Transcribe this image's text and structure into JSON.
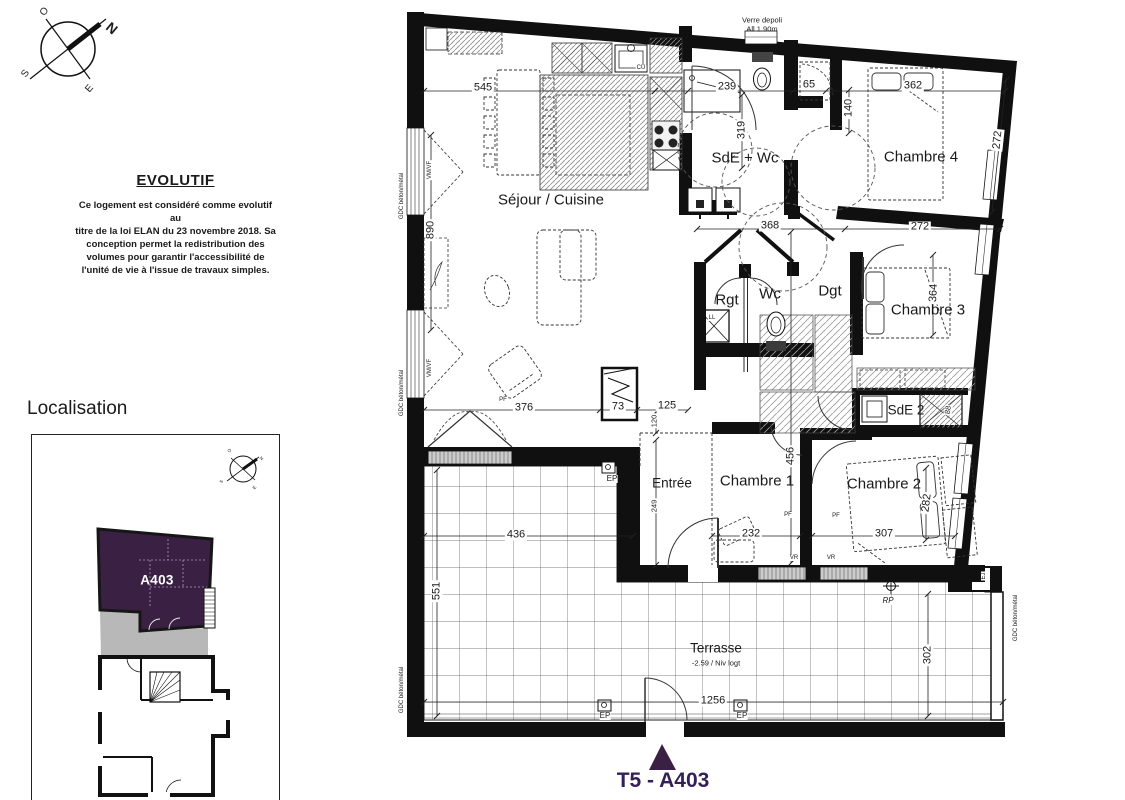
{
  "colors": {
    "plum": "#3a2144",
    "footer_text": "#342058",
    "wall": "#101010",
    "terrace_gray": "#b8b8b8"
  },
  "compass": {
    "labels": [
      {
        "t": "N",
        "x": 112,
        "y": 28,
        "rot": 40,
        "cls": "cN"
      },
      {
        "t": "O",
        "x": 45,
        "y": 12,
        "rot": -55,
        "cls": "cO"
      },
      {
        "t": "S",
        "x": 26,
        "y": 74,
        "rot": -55,
        "cls": "cO"
      },
      {
        "t": "E",
        "x": 90,
        "y": 89,
        "rot": -50,
        "cls": "cO"
      },
      {
        "t": "N",
        "x": 261,
        "y": 459,
        "rot": 40,
        "cls": "cMini"
      },
      {
        "t": "O",
        "x": 230,
        "y": 451,
        "rot": -55,
        "cls": "cMini"
      },
      {
        "t": "S",
        "x": 222,
        "y": 482,
        "rot": -55,
        "cls": "cMini"
      },
      {
        "t": "E",
        "x": 255,
        "y": 488,
        "rot": -50,
        "cls": "cMini"
      }
    ]
  },
  "evolutif": {
    "title": "EVOLUTIF",
    "body_lines": [
      "Ce logement est considéré comme evolutif au",
      "titre de la loi ELAN du 23 novembre 2018. Sa",
      "conception permet la redistribution des",
      "volumes pour garantir l'accessibilité de",
      "l'unité de vie à l'issue de travaux simples."
    ]
  },
  "localisation": {
    "title": "Localisation",
    "unit": "A403"
  },
  "footer": {
    "label": "T5 - A403"
  },
  "plan": {
    "rooms": [
      {
        "t": "Séjour / Cuisine",
        "x": 551,
        "y": 200
      },
      {
        "t": "SdE + Wc",
        "x": 745,
        "y": 158
      },
      {
        "t": "Chambre 4",
        "x": 921,
        "y": 157
      },
      {
        "t": "Rgt",
        "x": 727,
        "y": 300
      },
      {
        "t": "Wc",
        "x": 770,
        "y": 294
      },
      {
        "t": "Dgt",
        "x": 830,
        "y": 291
      },
      {
        "t": "Chambre 3",
        "x": 928,
        "y": 310
      },
      {
        "t": "SdE 2",
        "x": 906,
        "y": 410,
        "cls": "room-sm"
      },
      {
        "t": "Entrée",
        "x": 672,
        "y": 483,
        "cls": "room-sm"
      },
      {
        "t": "Chambre 1",
        "x": 757,
        "y": 481
      },
      {
        "t": "Chambre 2",
        "x": 884,
        "y": 484
      },
      {
        "t": "Terrasse",
        "x": 716,
        "y": 648,
        "cls": "room-sm"
      }
    ],
    "dims": [
      {
        "t": "545",
        "x": 483,
        "y": 88
      },
      {
        "t": "239",
        "x": 727,
        "y": 87
      },
      {
        "t": "65",
        "x": 809,
        "y": 85
      },
      {
        "t": "362",
        "x": 913,
        "y": 86
      },
      {
        "t": "140",
        "x": 849,
        "y": 108,
        "rot": -90
      },
      {
        "t": "272",
        "x": 998,
        "y": 140,
        "rot": -84
      },
      {
        "t": "319",
        "x": 742,
        "y": 130,
        "rot": -90
      },
      {
        "t": "890",
        "x": 431,
        "y": 230,
        "rot": -90
      },
      {
        "t": "368",
        "x": 770,
        "y": 226
      },
      {
        "t": "272",
        "x": 920,
        "y": 227
      },
      {
        "t": "364",
        "x": 934,
        "y": 293,
        "rot": -87
      },
      {
        "t": "88",
        "x": 948,
        "y": 410,
        "rot": -80,
        "cls": "dim-sm"
      },
      {
        "t": "456",
        "x": 791,
        "y": 456,
        "rot": -90
      },
      {
        "t": "376",
        "x": 524,
        "y": 408
      },
      {
        "t": "73",
        "x": 618,
        "y": 407
      },
      {
        "t": "125",
        "x": 667,
        "y": 406
      },
      {
        "t": "120",
        "x": 654,
        "y": 421,
        "rot": -90,
        "cls": "dim-sm"
      },
      {
        "t": "436",
        "x": 516,
        "y": 535
      },
      {
        "t": "551",
        "x": 437,
        "y": 591,
        "rot": -90
      },
      {
        "t": "249",
        "x": 654,
        "y": 506,
        "rot": -90,
        "cls": "dim-sm"
      },
      {
        "t": "232",
        "x": 751,
        "y": 534
      },
      {
        "t": "307",
        "x": 884,
        "y": 534
      },
      {
        "t": "282",
        "x": 927,
        "y": 503,
        "rot": -83
      },
      {
        "t": "302",
        "x": 928,
        "y": 655,
        "rot": -90
      },
      {
        "t": "1256",
        "x": 713,
        "y": 701
      }
    ],
    "notes": [
      {
        "t": "Verre depoli",
        "x": 762,
        "y": 20,
        "cls": "note-plain"
      },
      {
        "t": "All 1.90m",
        "x": 762,
        "y": 29,
        "cls": "note-plain"
      },
      {
        "t": "EP",
        "x": 612,
        "y": 479,
        "cls": "note"
      },
      {
        "t": "EP",
        "x": 605,
        "y": 716,
        "cls": "note"
      },
      {
        "t": "EP",
        "x": 742,
        "y": 716,
        "cls": "note"
      },
      {
        "t": "RP",
        "x": 888,
        "y": 601,
        "cls": "note-italic"
      },
      {
        "t": "EJ",
        "x": 984,
        "y": 576,
        "cls": "tiny",
        "rot": -90
      },
      {
        "t": "LL",
        "x": 712,
        "y": 318,
        "cls": "tiny"
      },
      {
        "t": "CU",
        "x": 641,
        "y": 68,
        "cls": "tiny"
      },
      {
        "t": "PF",
        "x": 503,
        "y": 400,
        "cls": "tiny"
      },
      {
        "t": "PF",
        "x": 788,
        "y": 515,
        "cls": "tiny"
      },
      {
        "t": "PF",
        "x": 836,
        "y": 516,
        "cls": "tiny"
      },
      {
        "t": "VR",
        "x": 794,
        "y": 558,
        "cls": "tiny"
      },
      {
        "t": "VR",
        "x": 831,
        "y": 558,
        "cls": "tiny"
      },
      {
        "t": "-2.59 / Niv logt",
        "x": 716,
        "y": 663,
        "cls": "note-plain"
      },
      {
        "t": "GDC béton/métal",
        "x": 402,
        "y": 196,
        "rot": -90,
        "cls": "tiny"
      },
      {
        "t": "GDC béton/métal",
        "x": 402,
        "y": 393,
        "rot": -90,
        "cls": "tiny"
      },
      {
        "t": "GDC béton/métal",
        "x": 402,
        "y": 690,
        "rot": -90,
        "cls": "tiny"
      },
      {
        "t": "GDC béton/métal",
        "x": 1016,
        "y": 618,
        "rot": -90,
        "cls": "tiny"
      },
      {
        "t": "VM/VF",
        "x": 430,
        "y": 170,
        "rot": -90,
        "cls": "tiny"
      },
      {
        "t": "VM/VF",
        "x": 430,
        "y": 368,
        "rot": -90,
        "cls": "tiny"
      }
    ]
  }
}
